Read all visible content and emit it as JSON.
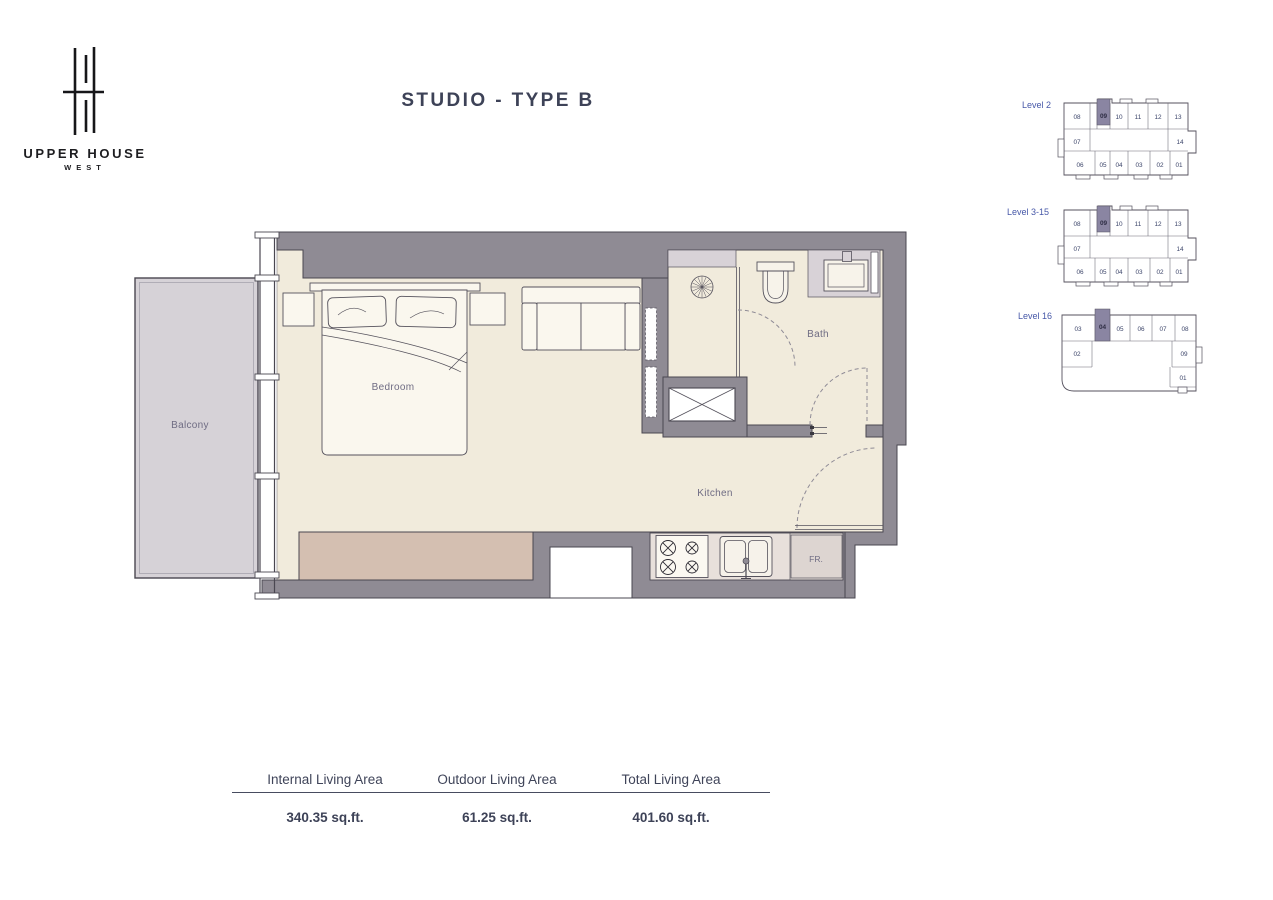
{
  "brand": {
    "name": "UPPER HOUSE",
    "tagline": "WEST"
  },
  "title": "STUDIO - TYPE B",
  "plan": {
    "labels": {
      "balcony": "Balcony",
      "bedroom": "Bedroom",
      "bath": "Bath",
      "kitchen": "Kitchen",
      "fridge": "FR."
    }
  },
  "levels": [
    {
      "label": "Level 2",
      "highlighted_unit": "09",
      "top": [
        "08",
        "09",
        "10",
        "11",
        "12",
        "13"
      ],
      "middle": [
        "07",
        "14"
      ],
      "bottom": [
        "06",
        "05",
        "04",
        "03",
        "02",
        "01"
      ]
    },
    {
      "label": "Level 3-15",
      "highlighted_unit": "09",
      "top": [
        "08",
        "09",
        "10",
        "11",
        "12",
        "13"
      ],
      "middle": [
        "07",
        "14"
      ],
      "bottom": [
        "06",
        "05",
        "04",
        "03",
        "02",
        "01"
      ]
    },
    {
      "label": "Level 16",
      "highlighted_unit": "04",
      "top": [
        "03",
        "04",
        "05",
        "06",
        "07",
        "08"
      ],
      "left": [
        "02"
      ],
      "right": [
        "09",
        "01"
      ]
    }
  ],
  "stats": {
    "columns": [
      {
        "label": "Internal Living Area",
        "value": "340.35 sq.ft."
      },
      {
        "label": "Outdoor Living Area",
        "value": "61.25 sq.ft."
      },
      {
        "label": "Total Living Area",
        "value": "401.60 sq.ft."
      }
    ]
  },
  "colors": {
    "wall": "#8f8b94",
    "floor": "#f1ebdc",
    "balcony_fill": "#d6d2d7",
    "counter": "#e8e0db",
    "wardrobe": "#d4bfb1",
    "unit_highlight": "#8a85a2",
    "title_text": "#3d4257",
    "level_label": "#4758a8",
    "room_label": "#6f6c83"
  }
}
